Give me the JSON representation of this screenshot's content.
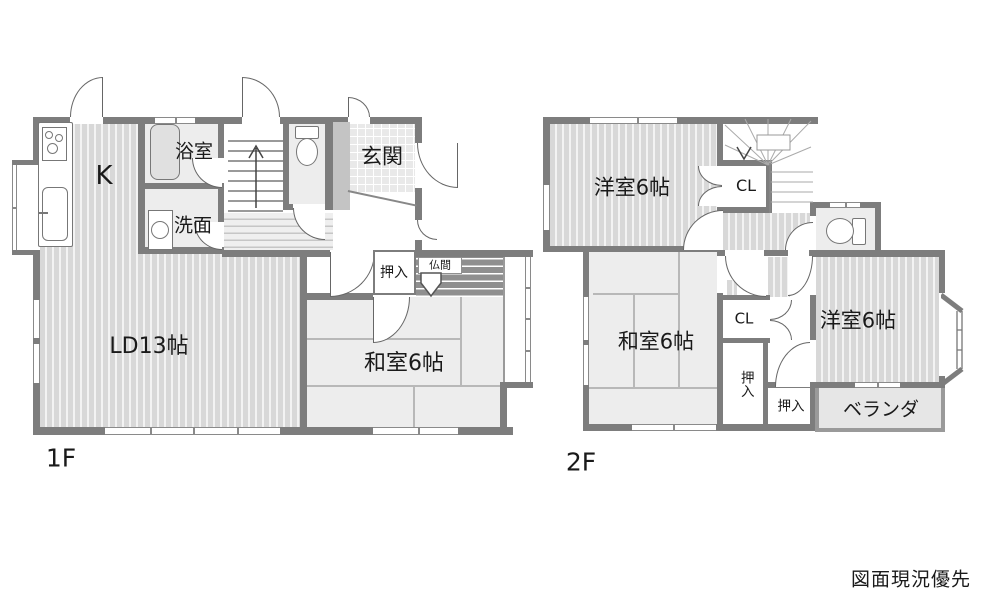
{
  "floor1": {
    "label": "1F",
    "kitchen": "K",
    "bath": "浴室",
    "wash": "洗面",
    "entrance": "玄関",
    "living_dining": "LD13帖",
    "japanese_room": "和室6帖",
    "closet": "押入",
    "butsuma": "仏間"
  },
  "floor2": {
    "label": "2F",
    "western_room_a": "洋室6帖",
    "closet_a": "CL",
    "japanese_room": "和室6帖",
    "closet_b": "CL",
    "oshiire_a": "押入",
    "oshiire_b": "押入",
    "western_room_b": "洋室6帖",
    "veranda": "ベランダ"
  },
  "note": "図面現況優先",
  "colors": {
    "wall": "#7d7d7d",
    "floor_stripe": "#d8d8d8",
    "floor_plain": "#ededed",
    "closet_band": "#8f8f8f",
    "entrance_tile": "#e9e9e9",
    "balcony": "#e6e6e6",
    "cabinet": "#c4c4c4"
  }
}
